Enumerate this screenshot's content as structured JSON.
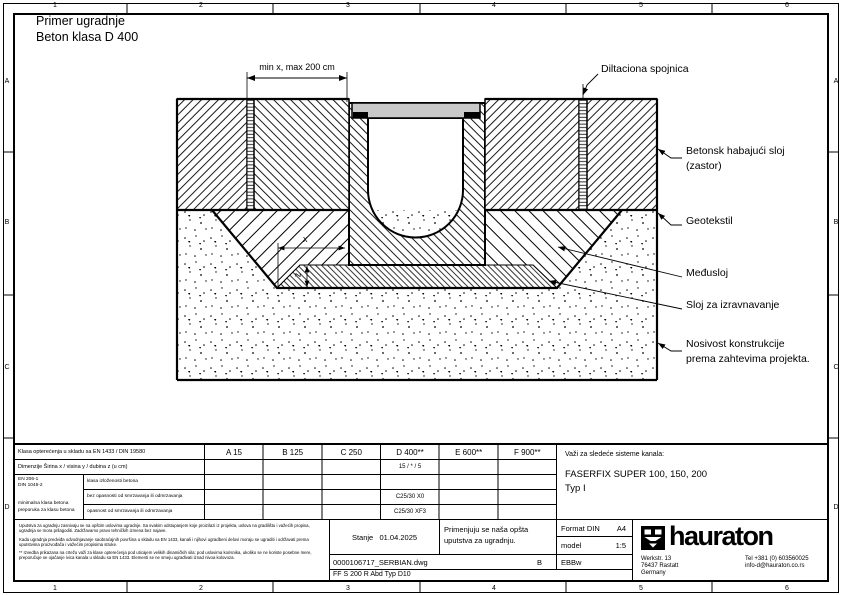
{
  "page": {
    "title_line1": "Primer ugradnje",
    "title_line2": "Beton klasa D 400"
  },
  "ruler": {
    "cols": [
      "1",
      "2",
      "3",
      "4",
      "5",
      "6"
    ],
    "rows": [
      "A",
      "B",
      "C",
      "D"
    ]
  },
  "drawing": {
    "dim_top": "min x, max 200 cm",
    "dim_x": "x",
    "dim_z": "z",
    "labels": {
      "dilatation": "Diltaciona spojnica",
      "wear_layer_1": "Betonsk habajući sloj",
      "wear_layer_2": "(zastor)",
      "geotextile": "Geotekstil",
      "interlayer": "Međusloj",
      "leveling": "Sloj za izravnavanje",
      "bearing_1": "Nosivost konstrukcije",
      "bearing_2": "prema zahtevima projekta."
    },
    "colors": {
      "grate_fill": "#c9c9c9",
      "line": "#000000"
    }
  },
  "load_table": {
    "header_label": "Klasa opterećenja u skladu sa EN 1433 / DIN 19580",
    "classes": [
      "A 15",
      "B 125",
      "C 250",
      "D 400**",
      "E 600**",
      "F 900**"
    ],
    "dims_label": "Dimenzije Širina x / visina y / dubina z (u cm)",
    "dims_value_d400": "15 / * / 5",
    "norm_line1": "EN 206-1",
    "norm_line2": "DIN 1045-2",
    "norm_note1": "minimalna klasa betona",
    "norm_note2": "preporuka za klasu betona",
    "exposure_rows": [
      {
        "label": "klasa izloženosti betona",
        "value_d400": ""
      },
      {
        "label": "bez opasnosti od smrzavanja ili odmrzavanja",
        "value_d400": "C25/30 X0"
      },
      {
        "label": "opasnost od smrzavanja ili odmrzavanja",
        "value_d400": "C25/30 XF3"
      }
    ]
  },
  "systems": {
    "heading": "Važi za sledeće sisteme kanala:",
    "line1": "FASERFIX SUPER 100, 150, 200",
    "line2": "Typ I"
  },
  "titleblock": {
    "disclaimer_p1": "Uputstva za ugradnju zasnivaju se na opštim uslovima ugradnje. Sa svakim odstupanjem koje proizilazi iz projekta, uslova na gradilištu i važećih propisa, ugradnja se mora prilagoditi. Zadržavamo pravo tehničkih izmena bez najave.",
    "disclaimer_p2": "Kada ugradnja predviđa odvodnjavanje saobraćajnih površina u skladu sa EN 1433, kanali i njihovi ugradbeni delovi moraju se ugraditi i održavati prema uputstvima proizvođača i važećim propisima struke.",
    "disclaimer_p3": "** Izvedba prikazana na crtežu važi za klase opterećenja pod uticajem velikih dinamičkih sila; pod uslovima korisnika, ukoliko se ne koriste posebne mere, preporučuje se ojačanje ivica kanala u skladu sa EN 1433. Elementi se ne smeju ugrađivati iznad nivoa kolovoza.",
    "status_label": "Stanje",
    "status_date": "01.04.2025",
    "note": "Primenjuju se naša opšta uputstva za ugradnju.",
    "format_label": "Format DIN",
    "format_value": "A4",
    "scale_label": "model",
    "scale_value": "1:5",
    "filename": "0000106717_SERBIAN.dwg",
    "revision": "B",
    "code": "EBBw",
    "type_line": "FF  S 200 R Abd Typ D10",
    "brand": "hauraton",
    "address_1": "Werkstr. 13",
    "address_2": "76437 Rastatt",
    "address_3": "Germany",
    "contact_1": "Tel +381 (0) 603560025",
    "contact_2": "info-d@hauraton.co.rs"
  }
}
